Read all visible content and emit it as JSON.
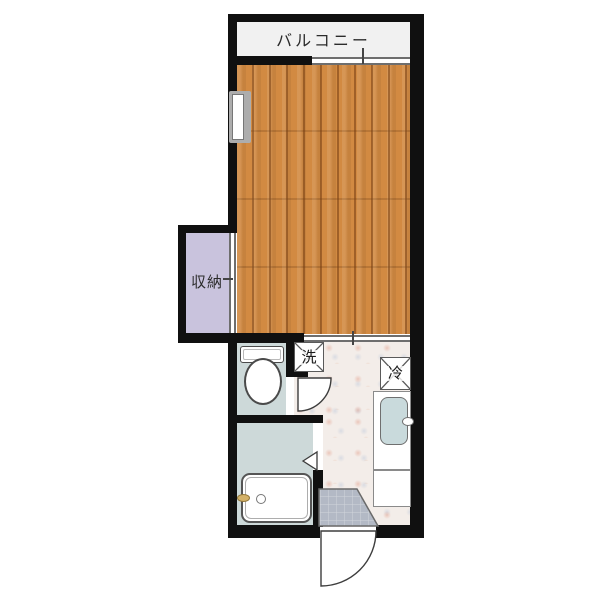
{
  "floorplan": {
    "type": "japanese-apartment-floorplan",
    "labels": {
      "balcony": "バルコニー",
      "storage": "収納",
      "washing_machine": "洗",
      "refrigerator": "冷"
    },
    "colors": {
      "wall": "#101010",
      "wood_floor": "#d28a42",
      "wood_floor_dark": "#bc7330",
      "storage_fill": "#c9c3dd",
      "wet_room_fill": "#cdd9d9",
      "balcony_fill": "#f1f1f1",
      "hallway_fill": "#f3ede9",
      "genkan_tile": "#b3b9c5",
      "sink_fill": "#c9dadc",
      "faucet_gold": "#d4b269"
    },
    "fixtures": [
      "toilet",
      "bathtub",
      "kitchen-sink",
      "washing-machine-space",
      "refrigerator-space",
      "entrance-door",
      "toilet-door",
      "bath-folding-door",
      "balcony-window",
      "room-window",
      "storage-sliding-door",
      "main-room-sliding-door",
      "entrance-genkan"
    ]
  }
}
